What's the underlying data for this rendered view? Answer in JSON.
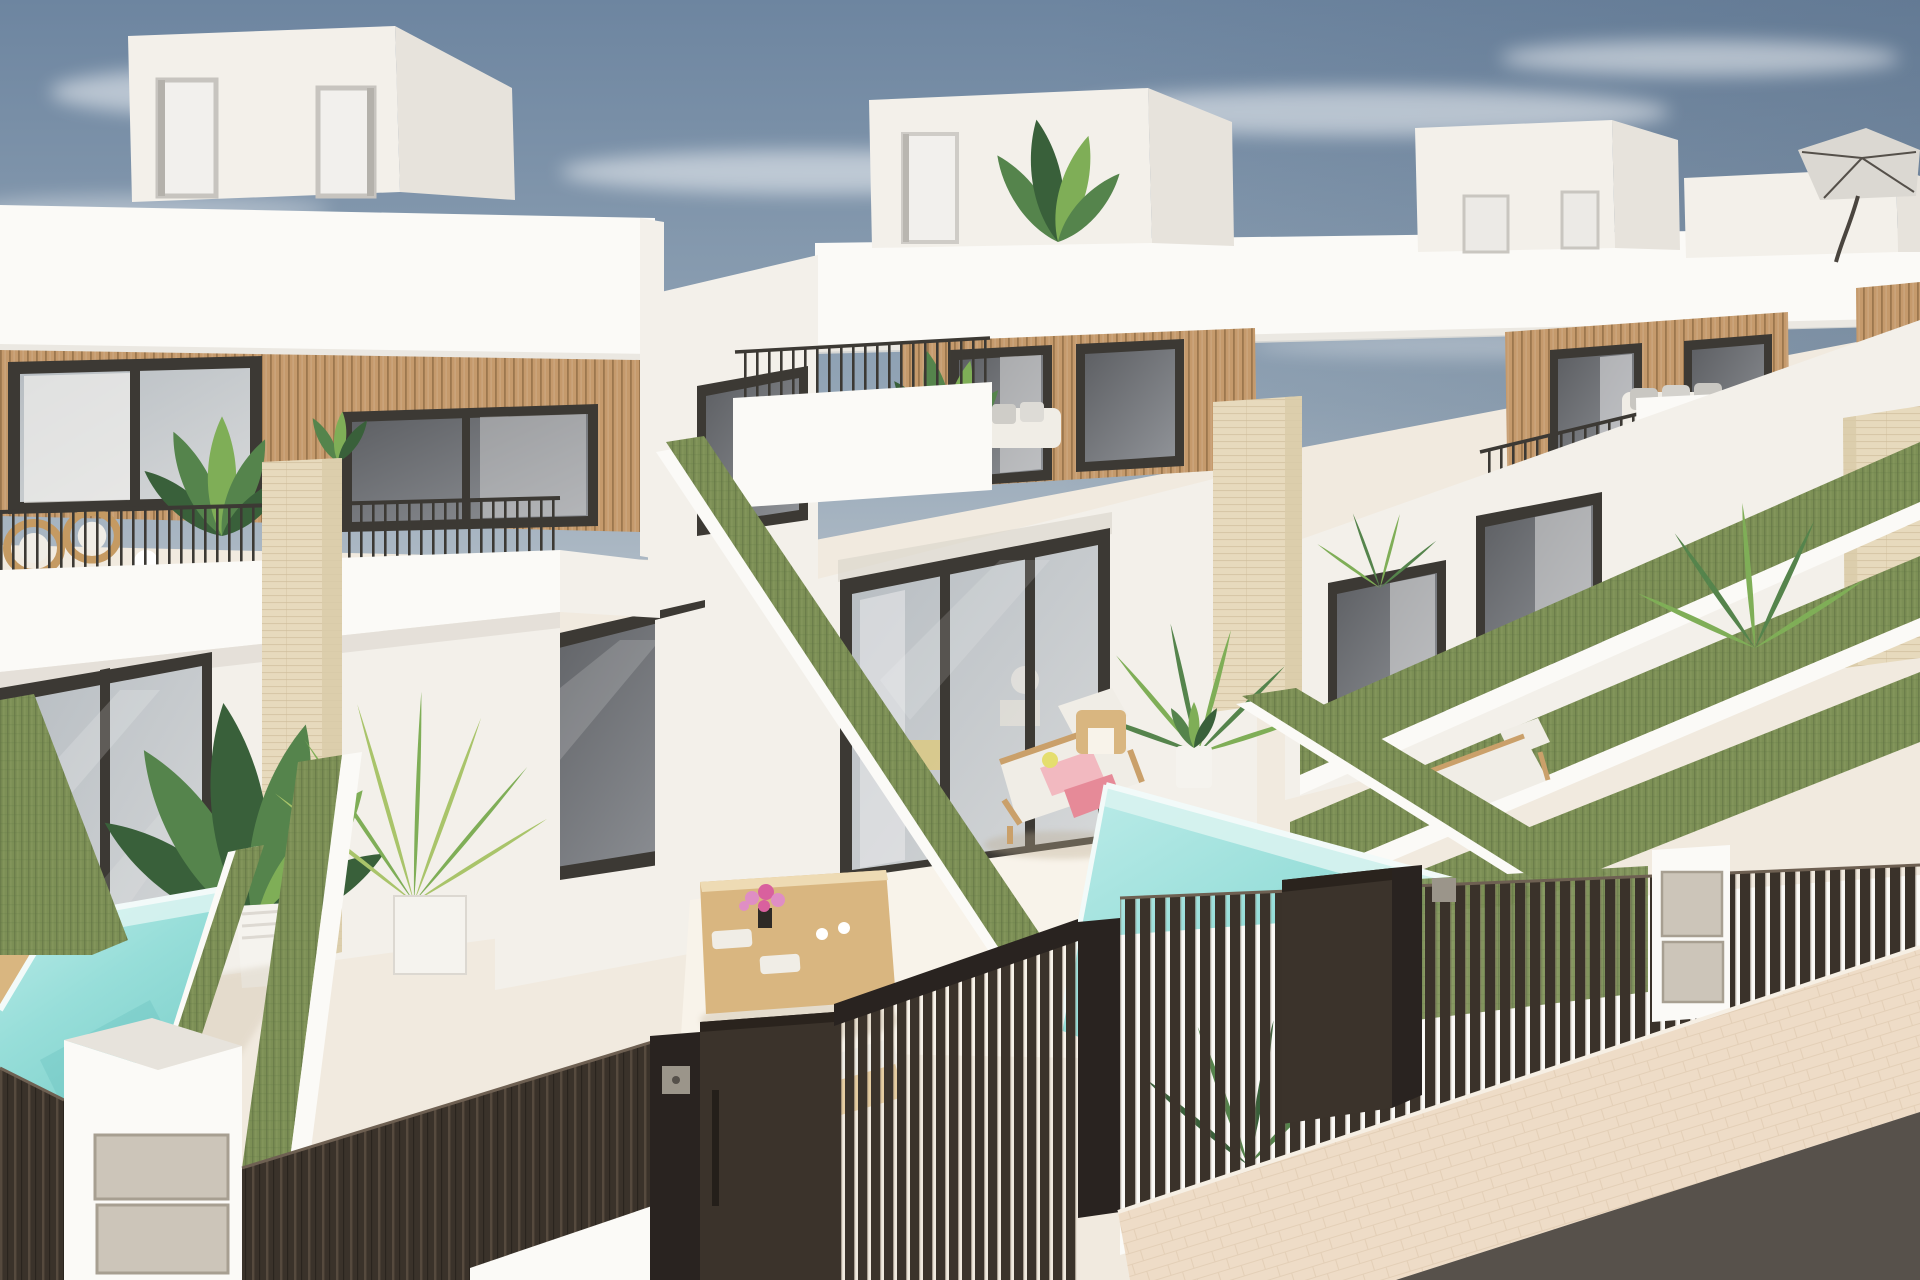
{
  "scene": {
    "subject": "Exterior 3D render of a row of new-build white terraced villas with wood-slat facades, balconies, green privacy hedges, small turquoise pools, dark slatted entrance gates and a paved sidewalk"
  },
  "palette": {
    "sky_top": "#6d85a0",
    "sky_mid": "#93a5b6",
    "sky_horizon": "#c6cdd3",
    "cloud": "#ffffff",
    "wall": "#f3f0ea",
    "wall_bright": "#fbfaf7",
    "wall_shade": "#e7e3dc",
    "wall_dark": "#d8d3ca",
    "frame": "#3c3934",
    "glass_hi": "#b7bdc2",
    "glass_hi2": "#d6d8d9",
    "glass_dark": "#5d5f63",
    "glass_dark2": "#909398",
    "curtain": "#ebebec",
    "wood": "#c59a6c",
    "wood_dark": "#8e6a44",
    "stone": "#e7dabd",
    "stone_line": "#cdbb97",
    "stone_shade": "#d9cba9",
    "hedge": "#7c8f55",
    "hedge_dark": "#5c6e41",
    "hedge_light": "#94a56b",
    "pool_light": "#bdece9",
    "pool_mid": "#97ded9",
    "pool_deep": "#7ed0cb",
    "pool_wall": "#d8f3f0",
    "coping": "#f2faf9",
    "fence": "#3a322a",
    "fence_hi": "#5c5044",
    "gate": "#3b332b",
    "gate_frame": "#292320",
    "floor": "#f1eadf",
    "floor_bright": "#f8f3ea",
    "pave": "#eedcc7",
    "pave_line": "#dfc9af",
    "road": "#57514b",
    "cushion": "#f0ede6",
    "rattan": "#c59a62",
    "wood_furn": "#d9b680",
    "metal": "#ccc5b9",
    "metal_line": "#a79f91",
    "towel_a": "#f2b9c0",
    "towel_b": "#e68a98",
    "flower_a": "#df8ec4",
    "flower_b": "#d9609e",
    "leaf_dark": "#39603a",
    "leaf_mid": "#55844c",
    "leaf_light": "#7fae57",
    "bamboo": "#a9c46a",
    "pot": "#f5f3ee",
    "shadow": "#b9a98e",
    "keypad": "#9b958a",
    "accent_yellow": "#e5de6e"
  }
}
